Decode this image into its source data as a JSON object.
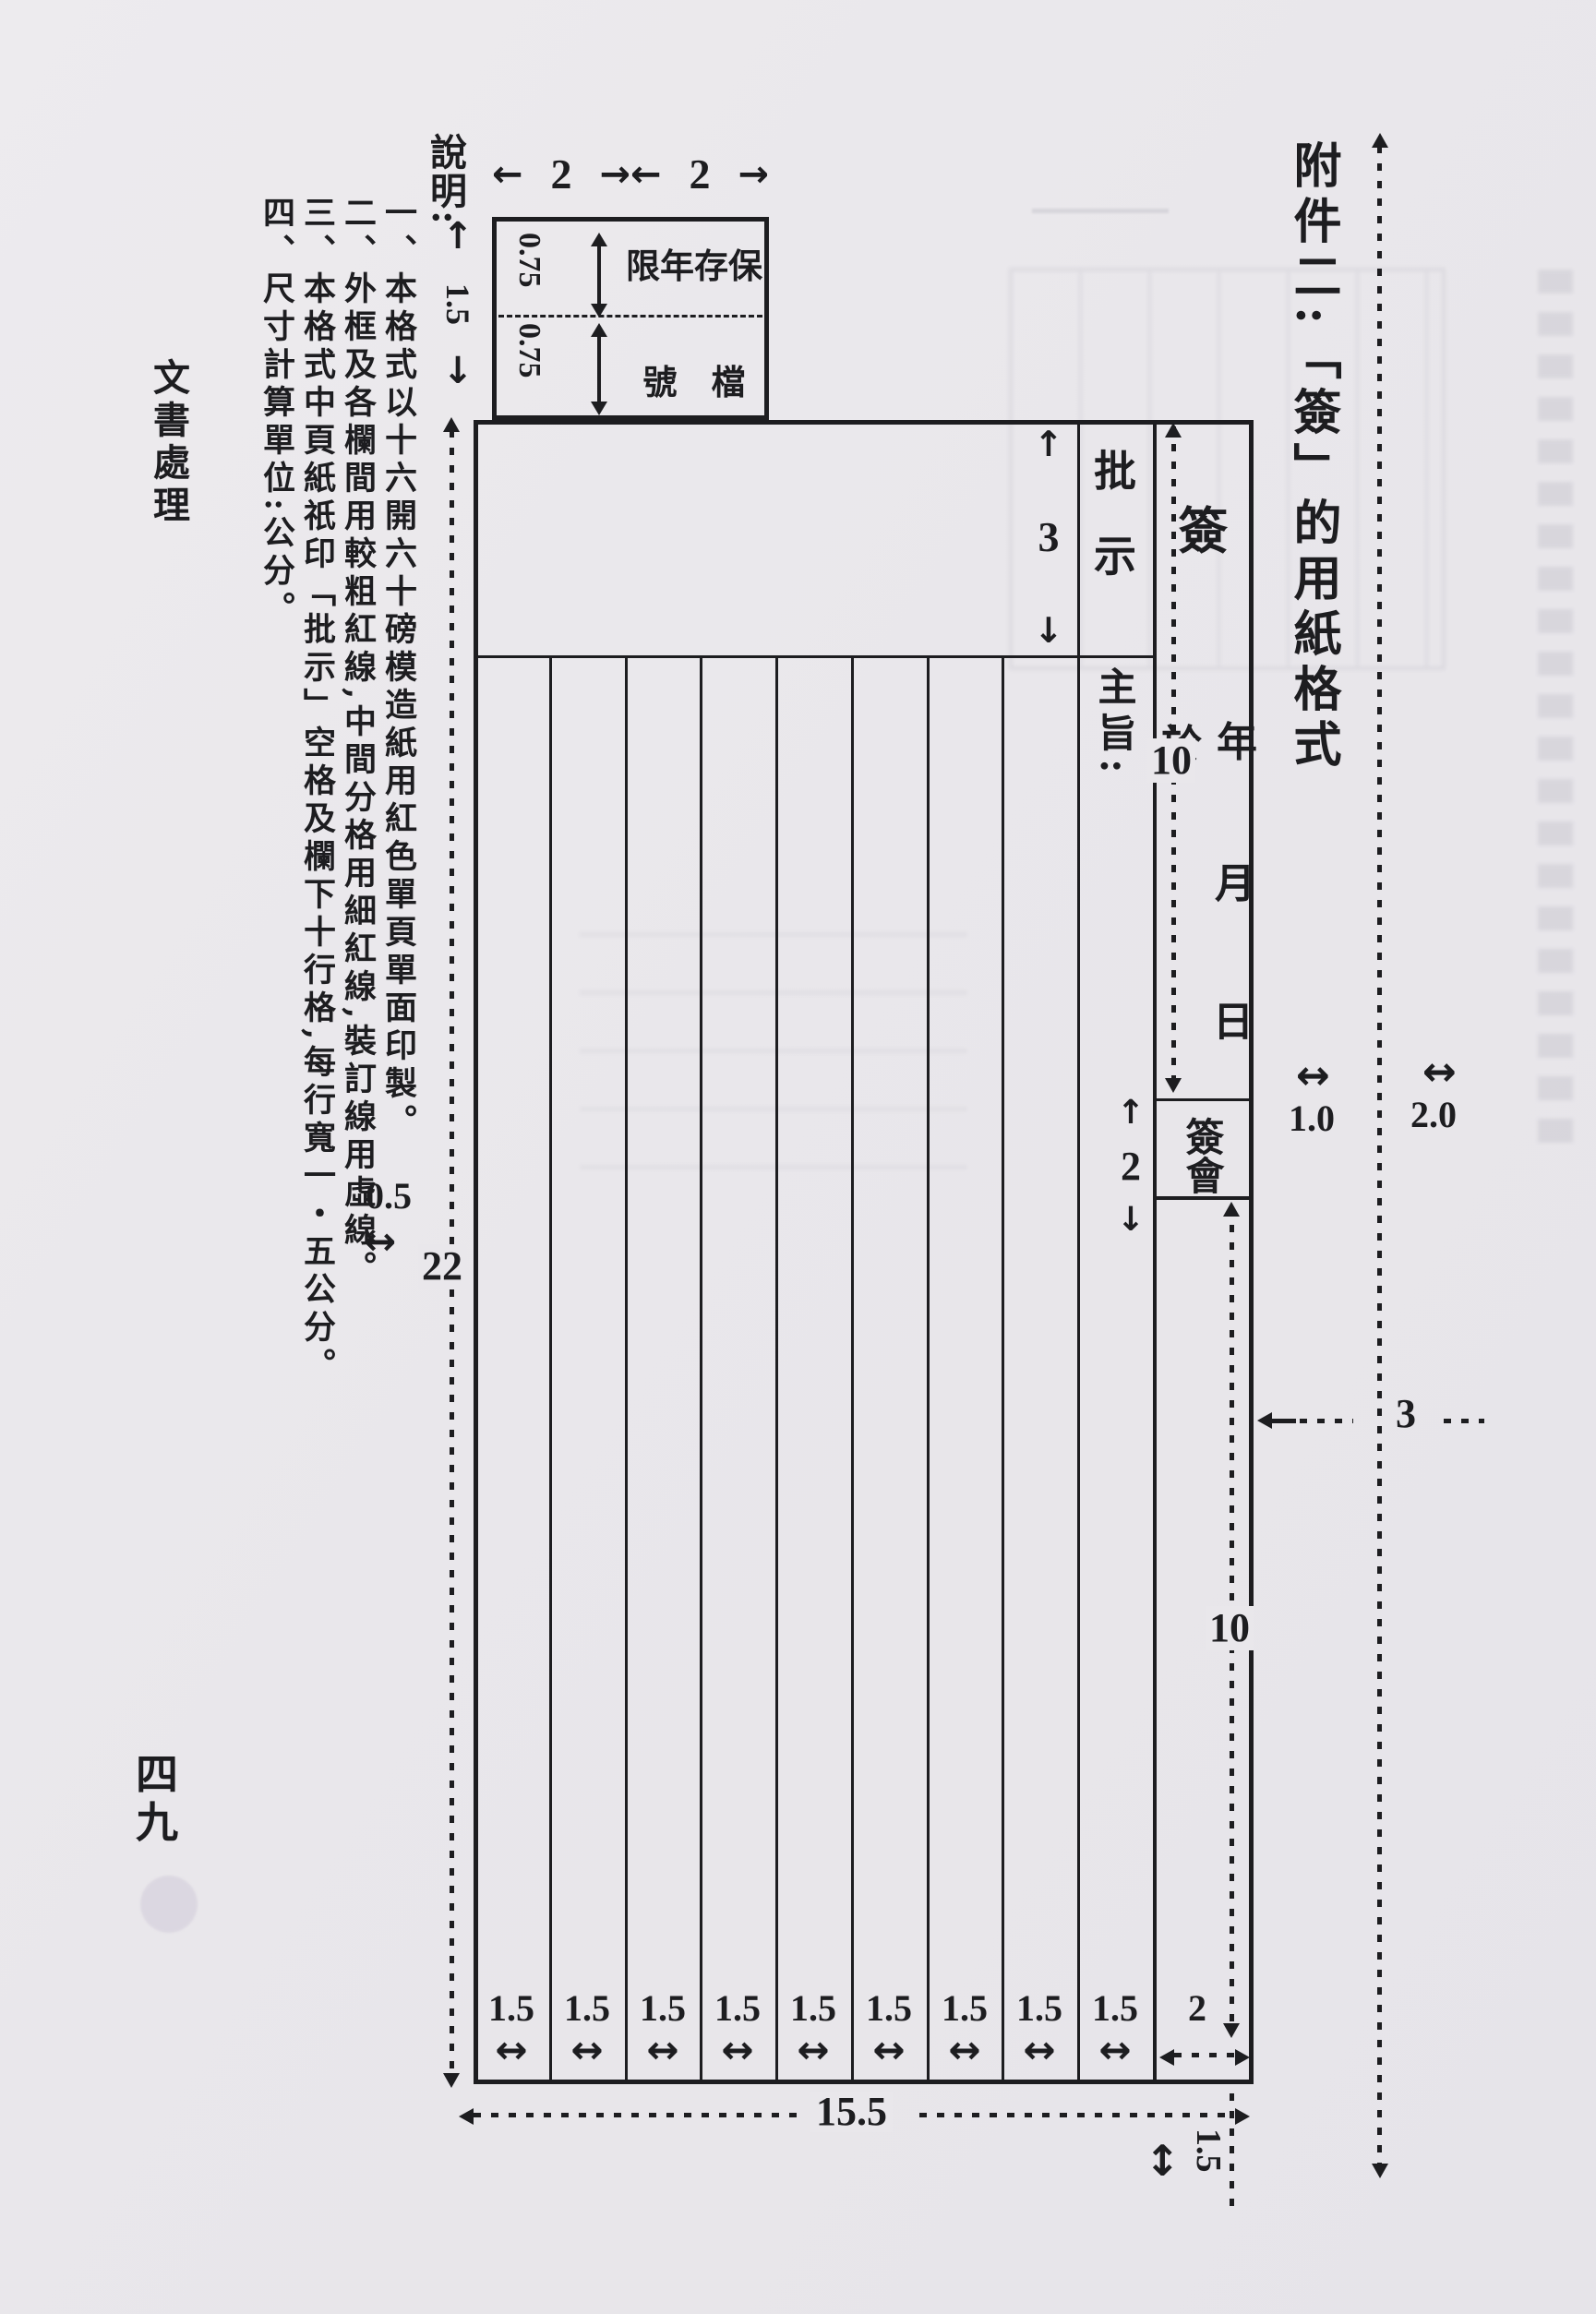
{
  "page": {
    "side_header": "文書處理",
    "page_number": "四九",
    "attachment_title": "附件二:「簽」的用紙格式",
    "notes_heading": "說明:",
    "notes": [
      "一、本格式以十六開六十磅模造紙用紅色單頁單面印製。",
      "二、外框及各欄間用較粗紅線,中間分格用細紅線,裝訂線用虛線。",
      "三、本格式中頁紙祇印「批示」空格及欄下十行格,每行寬一・五公分。",
      "四、尺寸計算單位:公分。"
    ]
  },
  "icons": {
    "arrow_left": "←",
    "arrow_right": "→",
    "arrow_up": "↑",
    "arrow_down": "↓",
    "arrow_both_h": "↔",
    "arrow_both_v": "↕"
  },
  "diagram": {
    "header_box": {
      "col_width_1": "2",
      "col_width_2": "2",
      "total_height": "1.5",
      "row_height_1": "0.75",
      "row_height_2": "0.75",
      "row1_label": "限年存保",
      "row2_label": "號　檔"
    },
    "approval": {
      "height": "3",
      "label": "批示",
      "subject_label": "主旨:"
    },
    "sign_column": {
      "upper_height": "10",
      "sign": "簽",
      "at": "於",
      "year": "年",
      "month": "月",
      "day": "日",
      "countersign_label": "簽　會",
      "countersign_height": "2",
      "lower_height": "10",
      "bottom_width": "2"
    },
    "column_widths": [
      "1.5",
      "1.5",
      "1.5",
      "1.5",
      "1.5",
      "1.5",
      "1.5",
      "1.5",
      "1.5"
    ],
    "overall": {
      "total_width": "15.5",
      "total_height": "22",
      "left_gap": "0.5",
      "right_gap_1": "1.0",
      "right_gap_2": "2.0",
      "right_total": "3",
      "bottom_gap": "1.5"
    }
  }
}
